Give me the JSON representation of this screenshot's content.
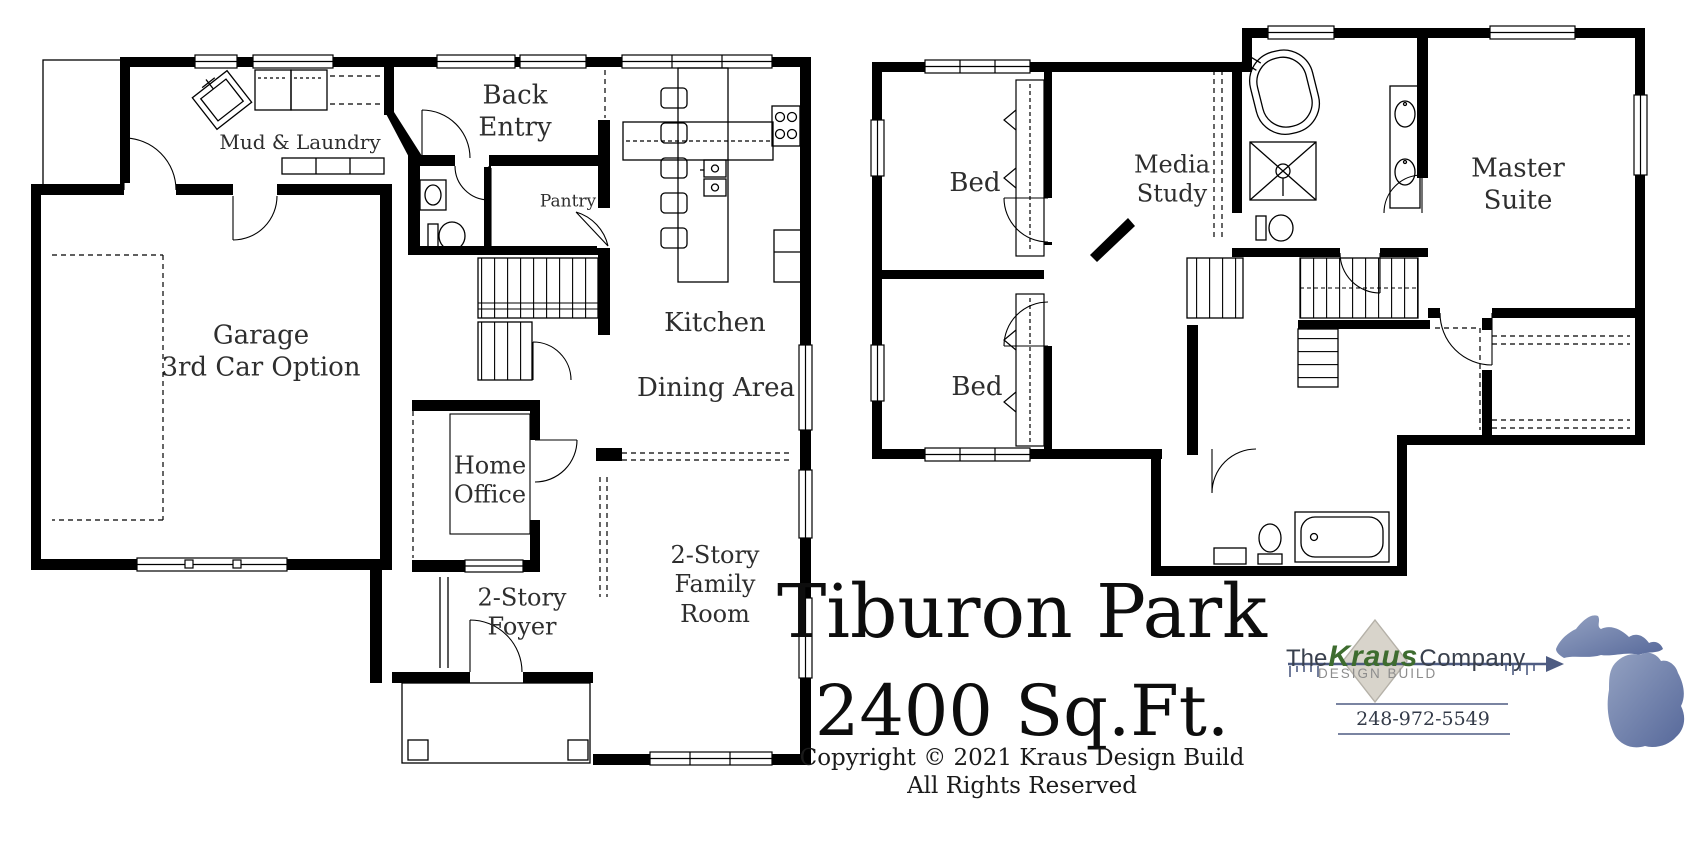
{
  "document": {
    "type": "residential floor plan sheet",
    "background_color": "#ffffff",
    "line_color": "#000000"
  },
  "plan": {
    "name": "Tiburon Park",
    "area": "2400 Sq.Ft.",
    "copyright_line1": "Copyright © 2021 Kraus Design Build",
    "copyright_line2": "All Rights Reserved"
  },
  "first_floor": {
    "rooms": [
      {
        "id": "mud-laundry",
        "label": "Mud & Laundry"
      },
      {
        "id": "back-entry",
        "label": "Back\nEntry"
      },
      {
        "id": "pantry",
        "label": "Pantry"
      },
      {
        "id": "kitchen",
        "label": "Kitchen"
      },
      {
        "id": "dining-area",
        "label": "Dining Area"
      },
      {
        "id": "garage",
        "label": "Garage\n3rd Car Option"
      },
      {
        "id": "home-office",
        "label": "Home\nOffice"
      },
      {
        "id": "foyer",
        "label": "2-Story\nFoyer"
      },
      {
        "id": "family-room",
        "label": "2-Story\nFamily\nRoom"
      }
    ]
  },
  "second_floor": {
    "rooms": [
      {
        "id": "bed-1",
        "label": "Bed"
      },
      {
        "id": "media-study",
        "label": "Media\nStudy"
      },
      {
        "id": "bed-2",
        "label": "Bed"
      },
      {
        "id": "master-suite",
        "label": "Master\nSuite"
      }
    ]
  },
  "logo": {
    "word_the": "The",
    "word_kraus": "Kraus",
    "word_company": "Company",
    "tagline": "DESIGN BUILD",
    "phone": "248-972-5549",
    "colors": {
      "kraus_green": "#3e6c2f",
      "ruler_blue": "#4e5c82",
      "michigan_fill_light": "#94a2c2",
      "michigan_fill_dark": "#56689a",
      "diamond_fill": "#d8d4cb",
      "diamond_stroke": "#b5b1a8"
    },
    "icons": [
      "ruler-arrow-icon",
      "diamond-icon",
      "michigan-state-icon"
    ]
  }
}
